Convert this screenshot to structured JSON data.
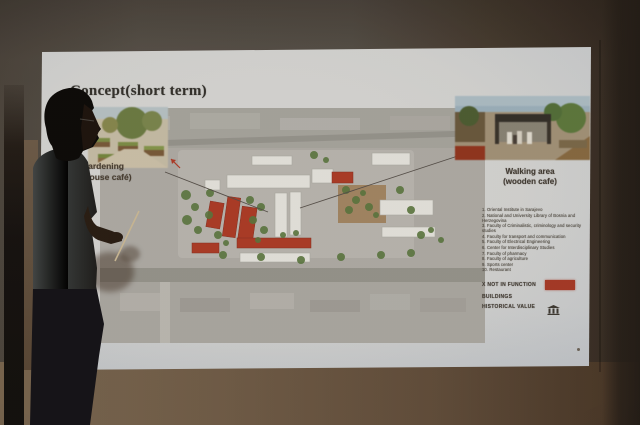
{
  "slide": {
    "title": "Concept(short term)",
    "callouts": {
      "garden": {
        "line1": "Urban gardening",
        "line2": "(green house café)"
      },
      "walking": {
        "line1": "Walking area",
        "line2": "(wooden cafe)"
      }
    },
    "legend": {
      "items": [
        "1. Oriental Institute in Sarajevo",
        "2. National and University Library of Bosnia and Herzegovina",
        "3. Faculty of Criminalistic, criminology and security studies",
        "4. Faculty for transport and communication",
        "5. Faculty of Electrical Engineering",
        "6. Center for Interdisciplinary Studies",
        "7. Faculty of pharmacy",
        "8. Faculty of agriculture",
        "9. Sports center",
        "10. Restaurant"
      ],
      "not_in_function_label": "X NOT IN FUNCTION",
      "buildings_label": "BUILDINGS",
      "historical_label": "HISTORICAL VALUE"
    },
    "colors": {
      "not_in_function_red": "#a93a27",
      "site_building_white": "#e8e6e0",
      "screen_surface": "#d6d7d5",
      "wall_brown": "#5a4a3a"
    }
  }
}
